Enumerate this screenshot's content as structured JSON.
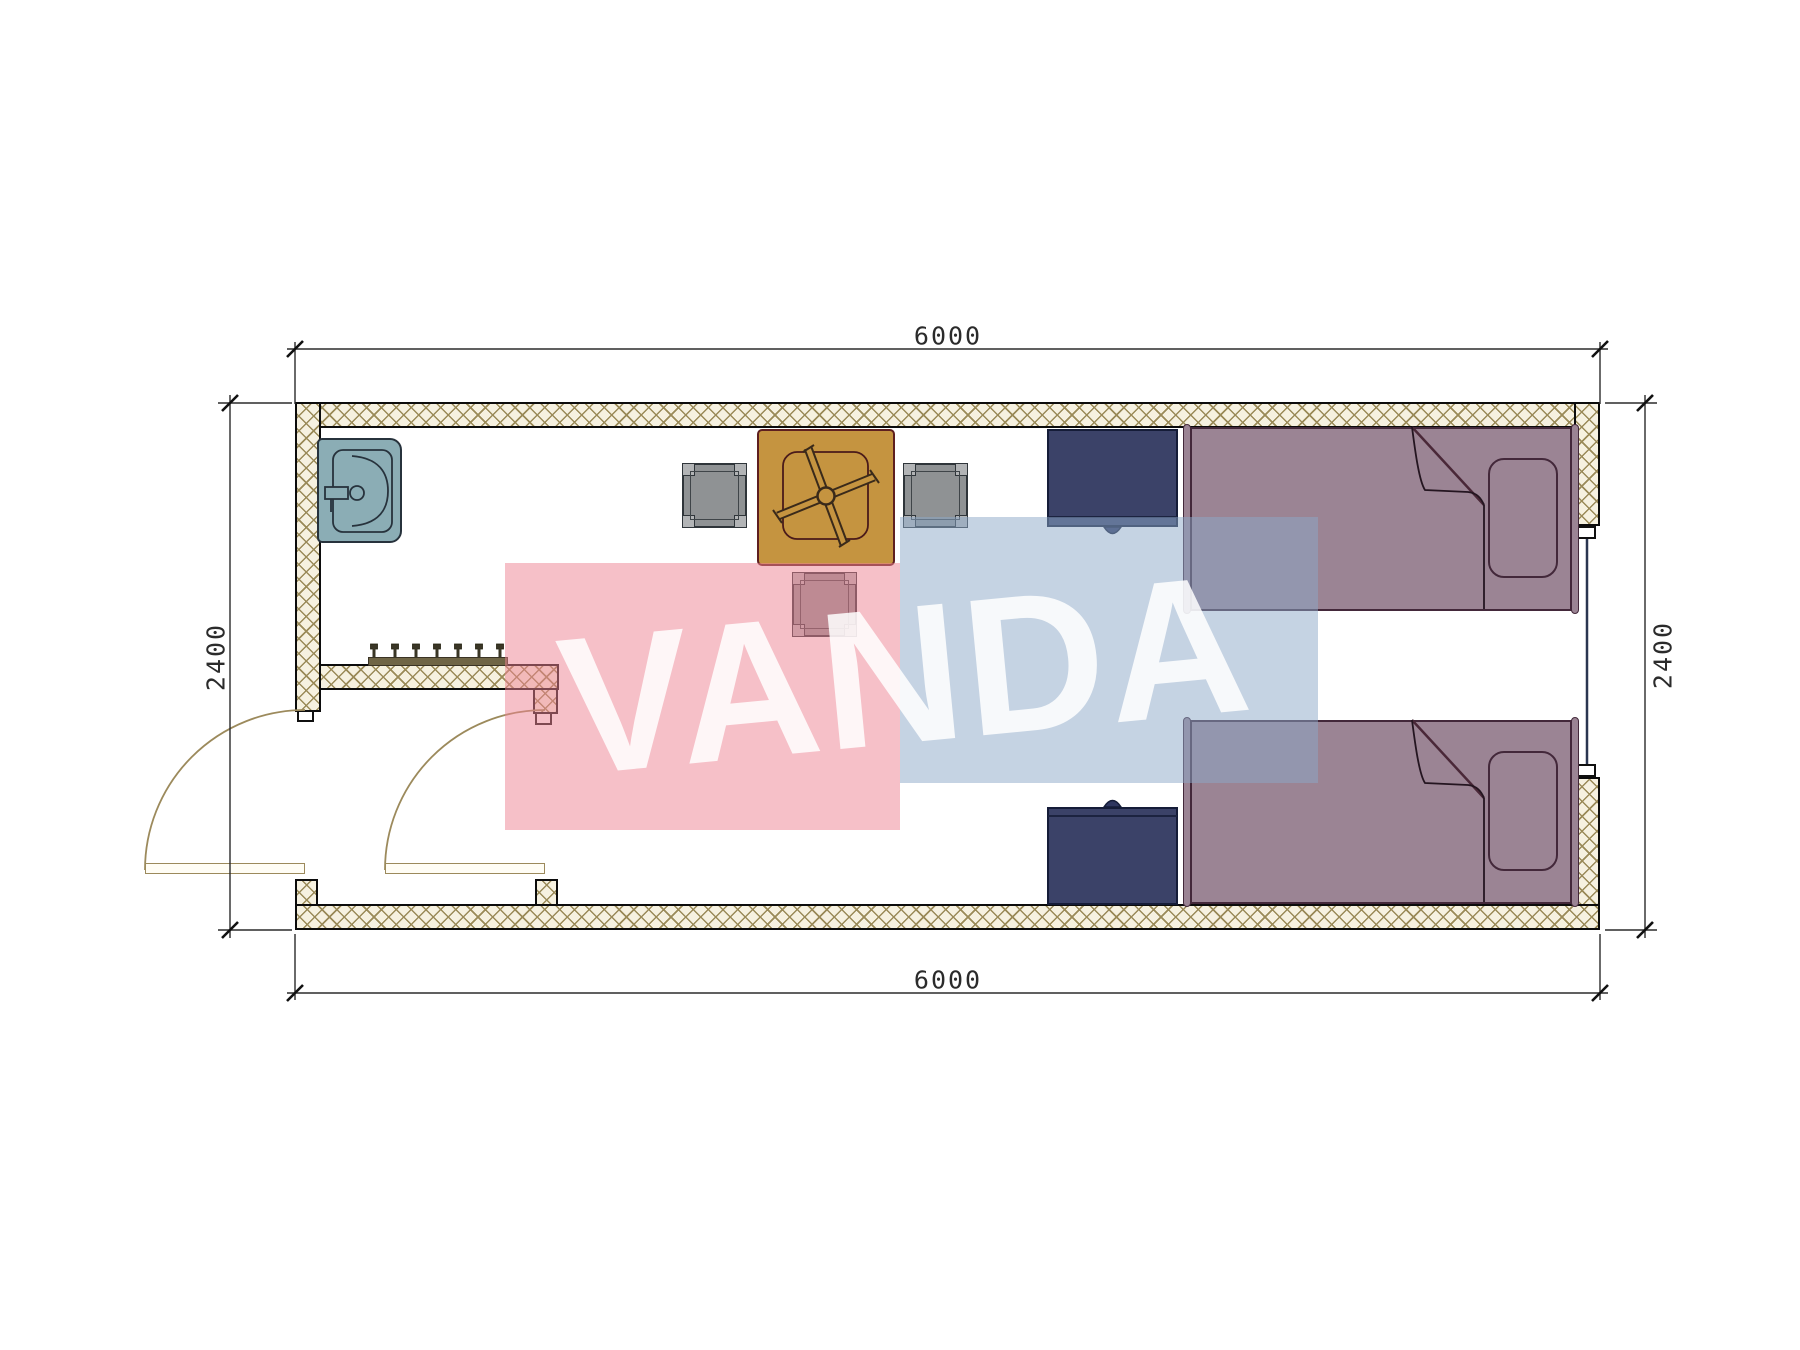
{
  "document": {
    "type": "architectural floor plan",
    "unit": "mm"
  },
  "dimensions": {
    "top": "6000",
    "bottom": "6000",
    "left": "2400",
    "right": "2400"
  },
  "watermark": {
    "text": "VANDA",
    "pink_color": "#ee8291",
    "blue_color": "#8ca8c8",
    "text_color": "#ffffff"
  },
  "plan": {
    "overall_width_mm": "6000",
    "overall_depth_mm": "2400",
    "rooms": [
      "entry vestibule",
      "main room"
    ],
    "furniture": [
      {
        "name": "sink",
        "count": 1
      },
      {
        "name": "coat rack",
        "count": 1,
        "hooks": 7
      },
      {
        "name": "square table with fan motif",
        "count": 1
      },
      {
        "name": "chair",
        "count": 3
      },
      {
        "name": "nightstand",
        "count": 2
      },
      {
        "name": "single bed with pillow and folded blanket",
        "count": 2
      },
      {
        "name": "swing door",
        "count": 2
      },
      {
        "name": "window",
        "count": 1
      }
    ]
  },
  "colors": {
    "wall_hatch_line": "#9a8a58",
    "wall_fill": "#f6f1e0",
    "wall_outline": "#0c0c0c",
    "sink": "#8badb5",
    "table": "#c59440",
    "chair": "#8f9294",
    "nightstand": "#3b4268",
    "bed": "#9b8494",
    "door_arc": "#9c8a5c",
    "window_line": "#2a3550",
    "dimension_text": "#2b2b2b"
  }
}
